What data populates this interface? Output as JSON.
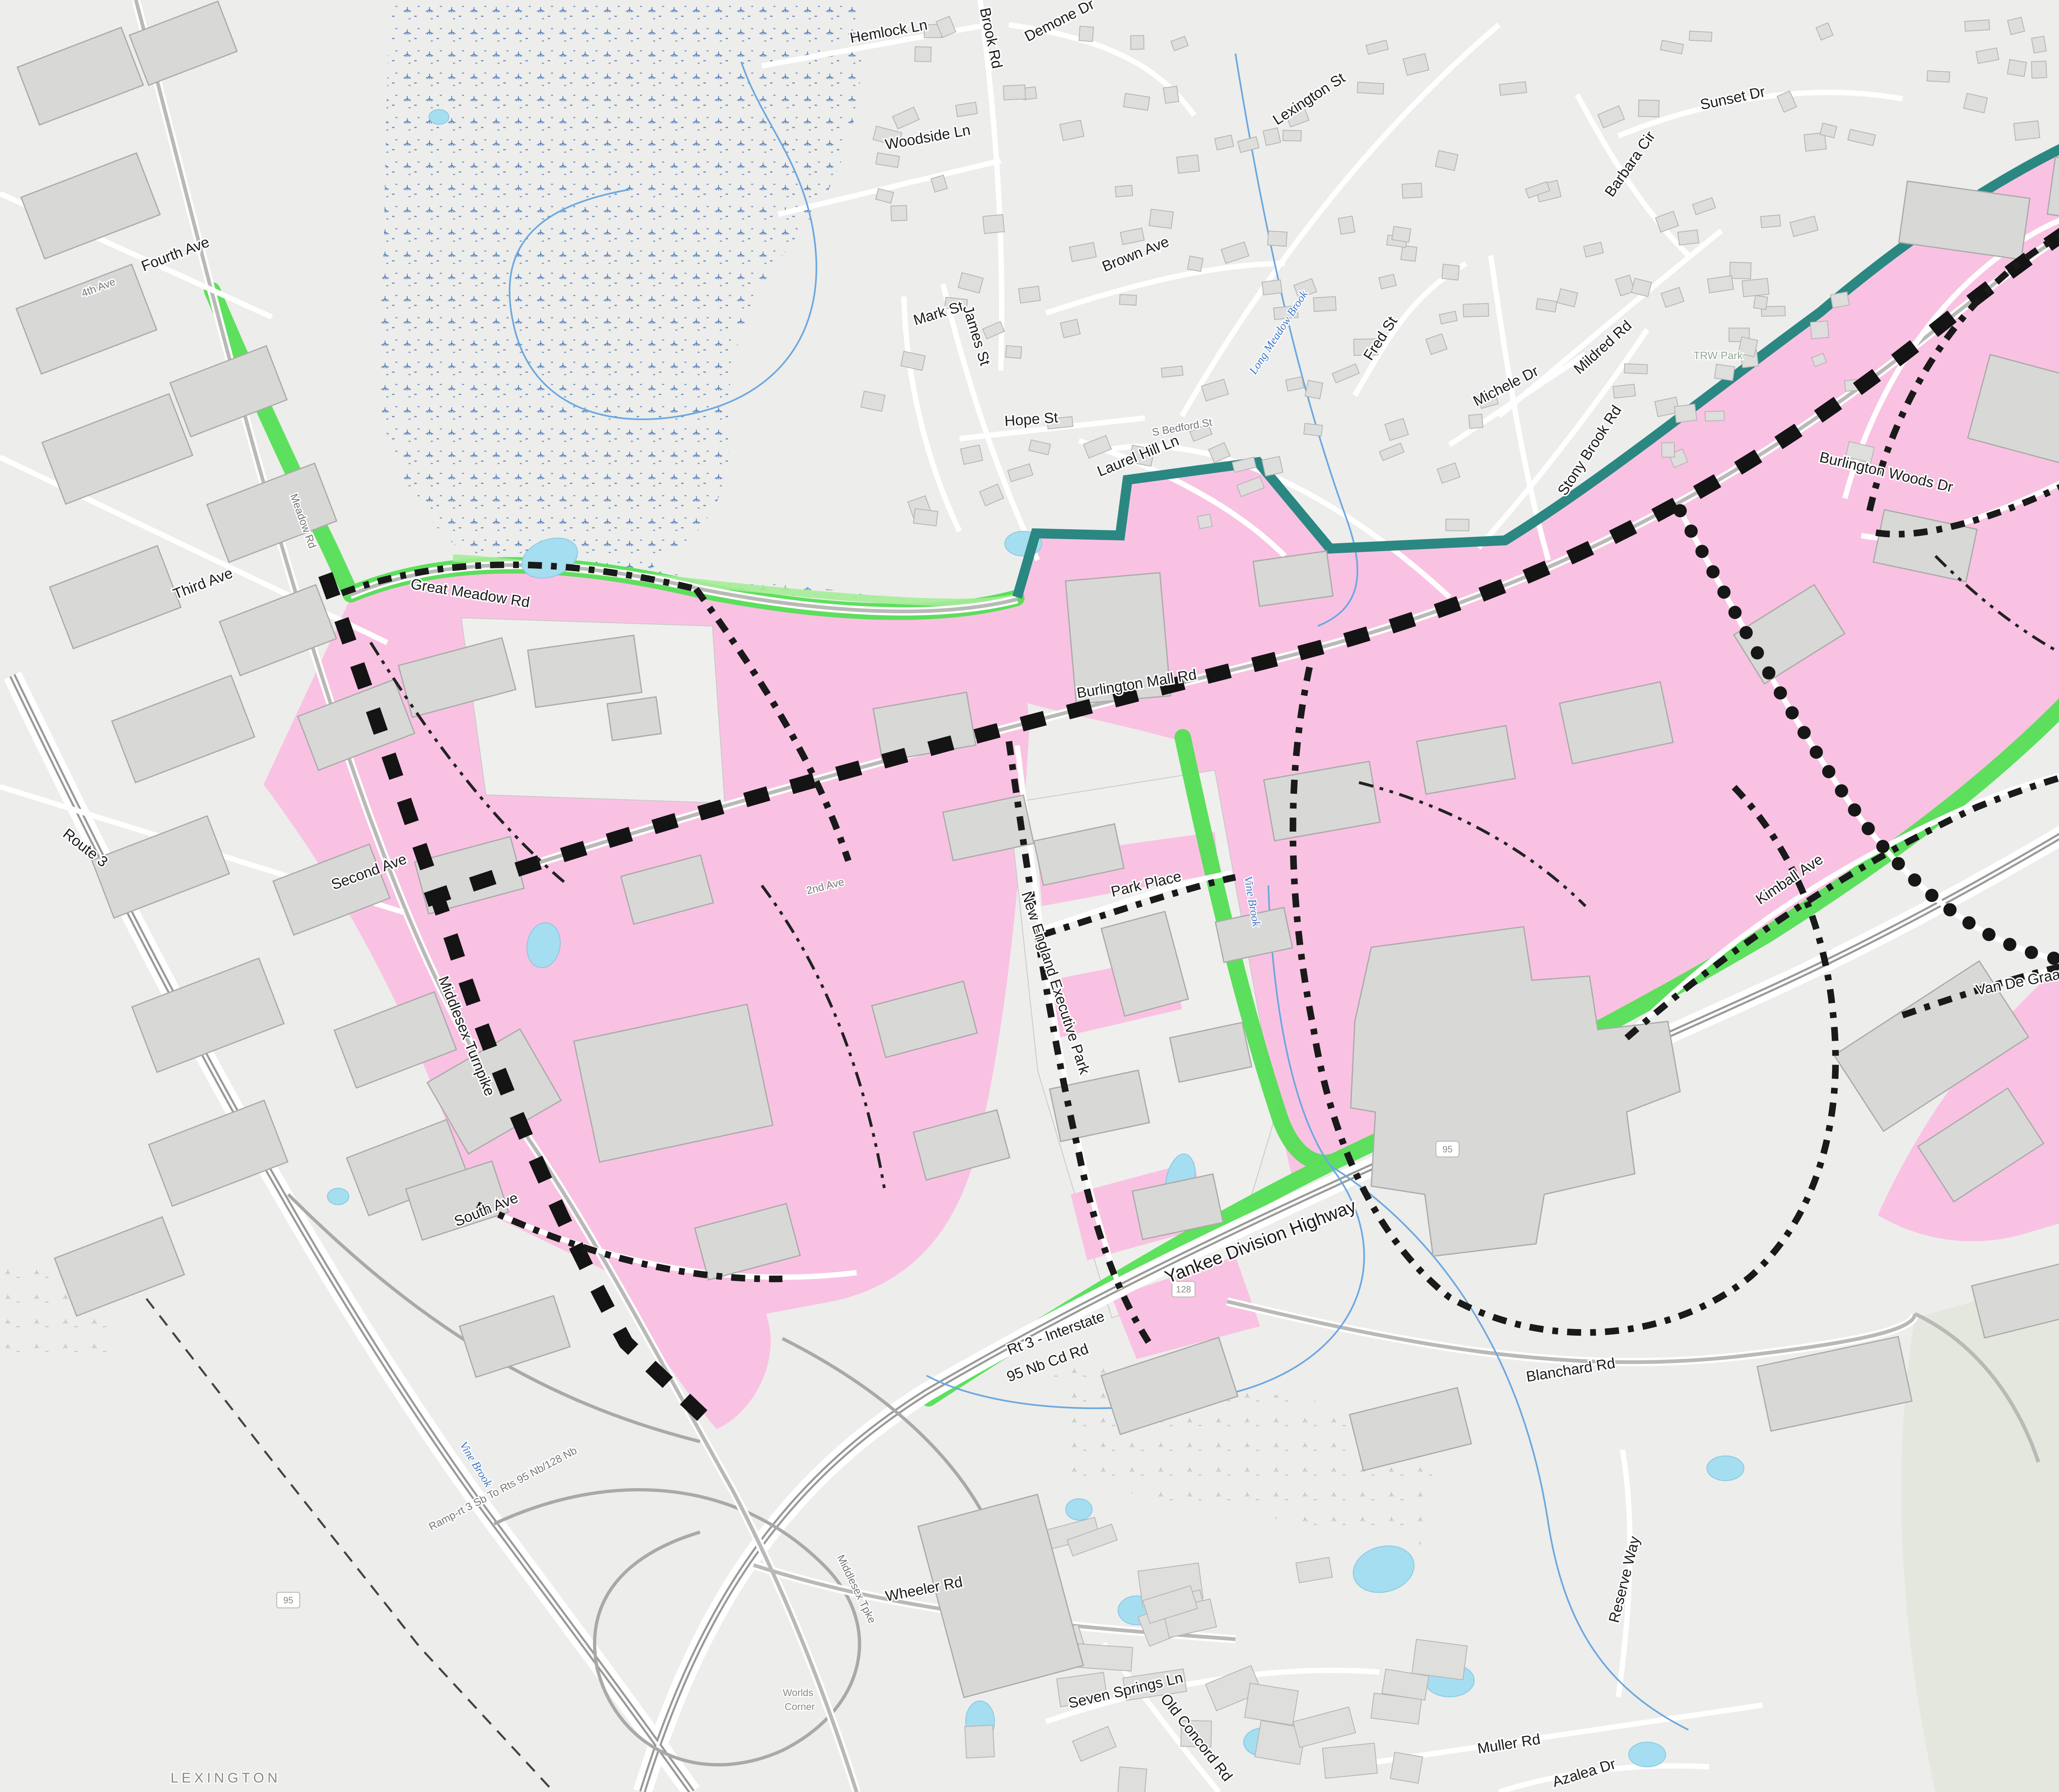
{
  "legend": {
    "title_line1": "Proposed MIX Zoning Concept",
    "title_line2": "September 25, 2023",
    "items": [
      {
        "type": "fill-gray",
        "label": "Building Footprints"
      },
      {
        "type": "fill-white",
        "label": "Parcel Boundaries"
      },
      {
        "type": "header",
        "label": "Zoning"
      },
      {
        "type": "fill-pink",
        "label": "MIX"
      },
      {
        "type": "line-gateway",
        "label": "Gateway Boulevard"
      },
      {
        "type": "line-collector",
        "label": "Collector Street"
      },
      {
        "type": "line-commercial",
        "label": "Commercial Street"
      },
      {
        "type": "line-local",
        "label": "Local Street"
      },
      {
        "type": "line-buffer",
        "label": "District Transition Buffer"
      },
      {
        "type": "fill-green",
        "label": "Greenway"
      }
    ],
    "data_sources": "Data Sources: MassGIS, Town of Burlington, AppGeo, Dodson & Flinker",
    "north_label": "N",
    "scale_labels": [
      "0",
      "125",
      "250",
      "500 Feet"
    ],
    "logo_brovitz_line1": "BROVITZ COMMUNITY PLANNING & DESIGN",
    "logo_brovitz_line2": "DISCOVERING COMMUNITY IDENTITY AND OPPORTUNITY",
    "logo_dodson_left": "Dodson",
    "logo_dodson_amp": "&",
    "logo_dodson_right": "Flinker",
    "logo_dodson_tagline": "Landscape Architecture and Planning"
  },
  "colors": {
    "mix_pink": "#F9C2E2",
    "legend_pink": "#FCC9EC",
    "buffer_teal": "#2B8782",
    "greenway_green": "#55DF55",
    "legend_green": "#77E877",
    "gateway_black": "#141414",
    "building_gray": "#D8D8D6",
    "water_blue": "#A5DEF0"
  },
  "map": {
    "labels": [
      [
        "Fourth Ave",
        430,
        628,
        -21,
        "lr"
      ],
      [
        "4th Ave",
        242,
        706,
        -21,
        "ls"
      ],
      [
        "Third Ave",
        497,
        1428,
        -21,
        "lr"
      ],
      [
        "Route 3",
        200,
        2068,
        38,
        "lr"
      ],
      [
        "Second Ave",
        900,
        2128,
        -20,
        "lr"
      ],
      [
        "2nd Ave",
        2006,
        2160,
        -14,
        "ls"
      ],
      [
        "Middlesex Turnpike",
        1122,
        2520,
        68,
        "lr"
      ],
      [
        "Middlesex Tpke",
        2072,
        3862,
        64,
        "ls"
      ],
      [
        "South Ave",
        1185,
        2948,
        -22,
        "lr"
      ],
      [
        "Great Meadow Rd",
        1140,
        1452,
        9,
        "lr"
      ],
      [
        "Meadow Rd",
        728,
        1268,
        70,
        "ls"
      ],
      [
        "Hemlock Ln",
        2160,
        88,
        -10,
        "lr"
      ],
      [
        "Brook Rd",
        2395,
        95,
        78,
        "lr"
      ],
      [
        "Demone Dr",
        2578,
        60,
        -27,
        "lr"
      ],
      [
        "Woodside Ln",
        2255,
        345,
        -10,
        "lr"
      ],
      [
        "Mark St",
        2282,
        772,
        -17,
        "lr"
      ],
      [
        "James St",
        2360,
        818,
        73,
        "lr"
      ],
      [
        "Lexington St",
        3185,
        250,
        -33,
        "lr"
      ],
      [
        "Brown Ave",
        2762,
        628,
        -22,
        "lr"
      ],
      [
        "Hope St",
        2505,
        1030,
        -4,
        "lr"
      ],
      [
        "Laurel Hill Ln",
        2768,
        1118,
        -22,
        "lr"
      ],
      [
        "Fred St",
        3362,
        828,
        -57,
        "lr"
      ],
      [
        "S Bedford St",
        2872,
        1046,
        -10,
        "ls"
      ],
      [
        "Long Meadow Brook",
        3112,
        812,
        -57,
        "lw"
      ],
      [
        "Michele Dr",
        3662,
        948,
        -27,
        "lr"
      ],
      [
        "Mildred Rd",
        3900,
        852,
        -42,
        "lr"
      ],
      [
        "Stony Brook Rd",
        3870,
        1100,
        -57,
        "lr"
      ],
      [
        "Sunset Dr",
        4210,
        250,
        -12,
        "lr"
      ],
      [
        "Barbara Cir",
        3968,
        405,
        -55,
        "lr"
      ],
      [
        "TRW Park",
        4172,
        872,
        0,
        "lp"
      ],
      [
        "Burlington Woods Dr",
        4578,
        1158,
        13,
        "lr"
      ],
      [
        "Cambridge St",
        5378,
        578,
        57,
        "lr"
      ],
      [
        "Cambridge St",
        5450,
        660,
        57,
        "ls"
      ],
      [
        "Burlington Mall Rd",
        2762,
        1672,
        -9,
        "lr"
      ],
      [
        "Park Place",
        2786,
        2158,
        -13,
        "lr"
      ],
      [
        "New England Executive Park",
        2552,
        2390,
        72,
        "lr"
      ],
      [
        "Kimball Ave",
        4352,
        2145,
        -34,
        "lr"
      ],
      [
        "Vine Brook",
        3032,
        2190,
        80,
        "lw"
      ],
      [
        "Vine Brook",
        1148,
        3560,
        58,
        "lw"
      ],
      [
        "Van De Graaff Dr",
        4936,
        2390,
        -11,
        "lr"
      ],
      [
        "Wayside Rd",
        5506,
        1855,
        -16,
        "lr"
      ],
      [
        "Yankee Division Highway",
        3066,
        3028,
        -21,
        "lh"
      ],
      [
        "Rt 3 - Interstate",
        2568,
        3248,
        -20,
        "lr"
      ],
      [
        "95 Nb Cd Rd",
        2548,
        3320,
        -20,
        "lr"
      ],
      [
        "Blanchard Rd",
        3816,
        3338,
        -9,
        "lr"
      ],
      [
        "Wheeler Rd",
        2246,
        3870,
        -11,
        "lr"
      ],
      [
        "Seven Springs Ln",
        2736,
        4116,
        -13,
        "lr"
      ],
      [
        "Old Concord Rd",
        2896,
        4226,
        52,
        "lr"
      ],
      [
        "Muller Rd",
        3666,
        4246,
        -9,
        "lr"
      ],
      [
        "Azalea Dr",
        3850,
        4316,
        -17,
        "lr"
      ],
      [
        "Reserve Way",
        3956,
        3838,
        -76,
        "lr"
      ],
      [
        "Ramp-rt 3 Sb To Rts 95 Nb/128 Nb",
        1225,
        3622,
        -28,
        "ls"
      ],
      [
        "Ramp-rts 3 Nb/3a Nb",
        5782,
        1452,
        73,
        "ls"
      ],
      [
        "To Rts 95 Sb/128 Sb",
        5850,
        1502,
        73,
        "ls"
      ],
      [
        "Mcnamara",
        6322,
        1032,
        57,
        "lr"
      ],
      [
        "Way",
        6305,
        1212,
        80,
        "lr"
      ],
      [
        "Mountain Rd",
        6565,
        1428,
        15,
        "lr"
      ],
      [
        "LilesBr ookCt",
        6520,
        1356,
        -11,
        "lr"
      ],
      [
        "Wall St",
        6286,
        1652,
        -4,
        "lr"
      ],
      [
        "Little Brook",
        6138,
        2228,
        -72,
        "lw"
      ],
      [
        "Lincoln",
        6188,
        2432,
        -10,
        "lr"
      ],
      [
        "Knoll Ln",
        6222,
        2502,
        -10,
        "lr"
      ],
      [
        "Ray Ave",
        6622,
        2552,
        -13,
        "lr"
      ],
      [
        "Worlds",
        1938,
        4118,
        0,
        "lp2"
      ],
      [
        "Corner",
        1942,
        4152,
        0,
        "lp2"
      ],
      [
        "ry Field",
        5120,
        2664,
        0,
        "lp"
      ],
      [
        "LEXINGTON",
        548,
        4328,
        0,
        "lt"
      ]
    ],
    "shields": [
      [
        "95",
        3515,
        2790
      ],
      [
        "95",
        700,
        3885
      ],
      [
        "95",
        6478,
        232
      ],
      [
        "128",
        2874,
        3130
      ],
      [
        "3A",
        5474,
        822
      ]
    ]
  }
}
